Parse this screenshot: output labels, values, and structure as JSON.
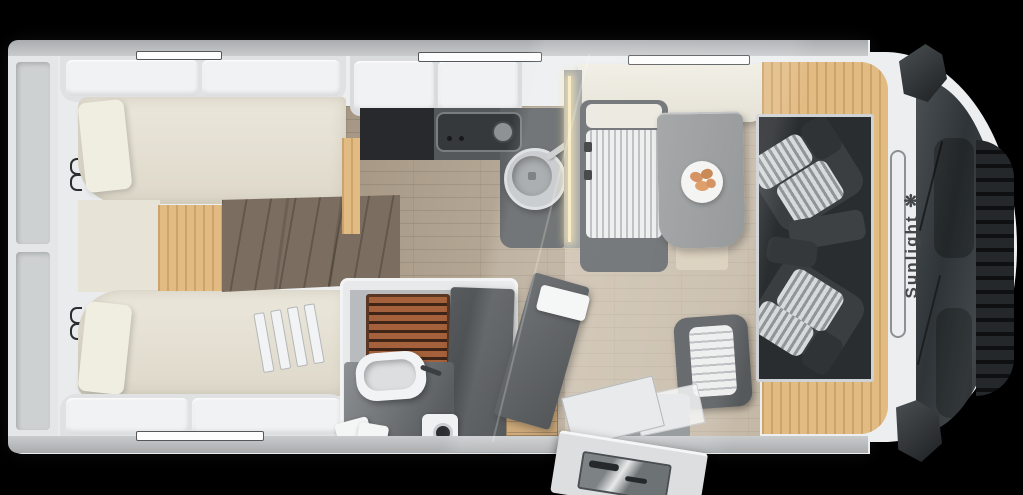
{
  "scene": {
    "type": "motorhome-floorplan-top-view",
    "brand": {
      "name": "Sunlight",
      "symbol": "❋"
    },
    "elements": [
      "rear-twin-beds",
      "bed-ladder",
      "wardrobe",
      "entry-steps",
      "kitchen-hob",
      "kitchen-sink",
      "overhead-lockers",
      "bathroom-shower-teak-grate",
      "washbasin",
      "bathroom-door-open",
      "towel",
      "dinette-bench",
      "dinette-table",
      "plate-of-croissants",
      "side-seat",
      "entrance-door-open",
      "cab-driver-seat",
      "cab-passenger-seat",
      "windshield",
      "side-mirrors",
      "overcab-bed"
    ]
  },
  "palette": {
    "bg": "#000000",
    "body": "#eceeef",
    "wall": "#b7babc",
    "mattress": "#e8e4d8",
    "oak": "#e2bb83",
    "walnut": "#7b6d5f",
    "floor": "#b2a593",
    "counter": "#54585a",
    "hob": "#35393c",
    "teak": "#a4613b",
    "partition": "#979b9e",
    "led": "#f8e9bd",
    "cushion": "#eceded",
    "cushionStripe": "#b6babc",
    "tableTop": "#929596",
    "croissant": "#d0854f",
    "seatDark": "#3a3e41",
    "cabFloor": "#2a2d30",
    "windshield": "#31373a",
    "grille": "#24282b",
    "brandInk": "#43474a"
  }
}
